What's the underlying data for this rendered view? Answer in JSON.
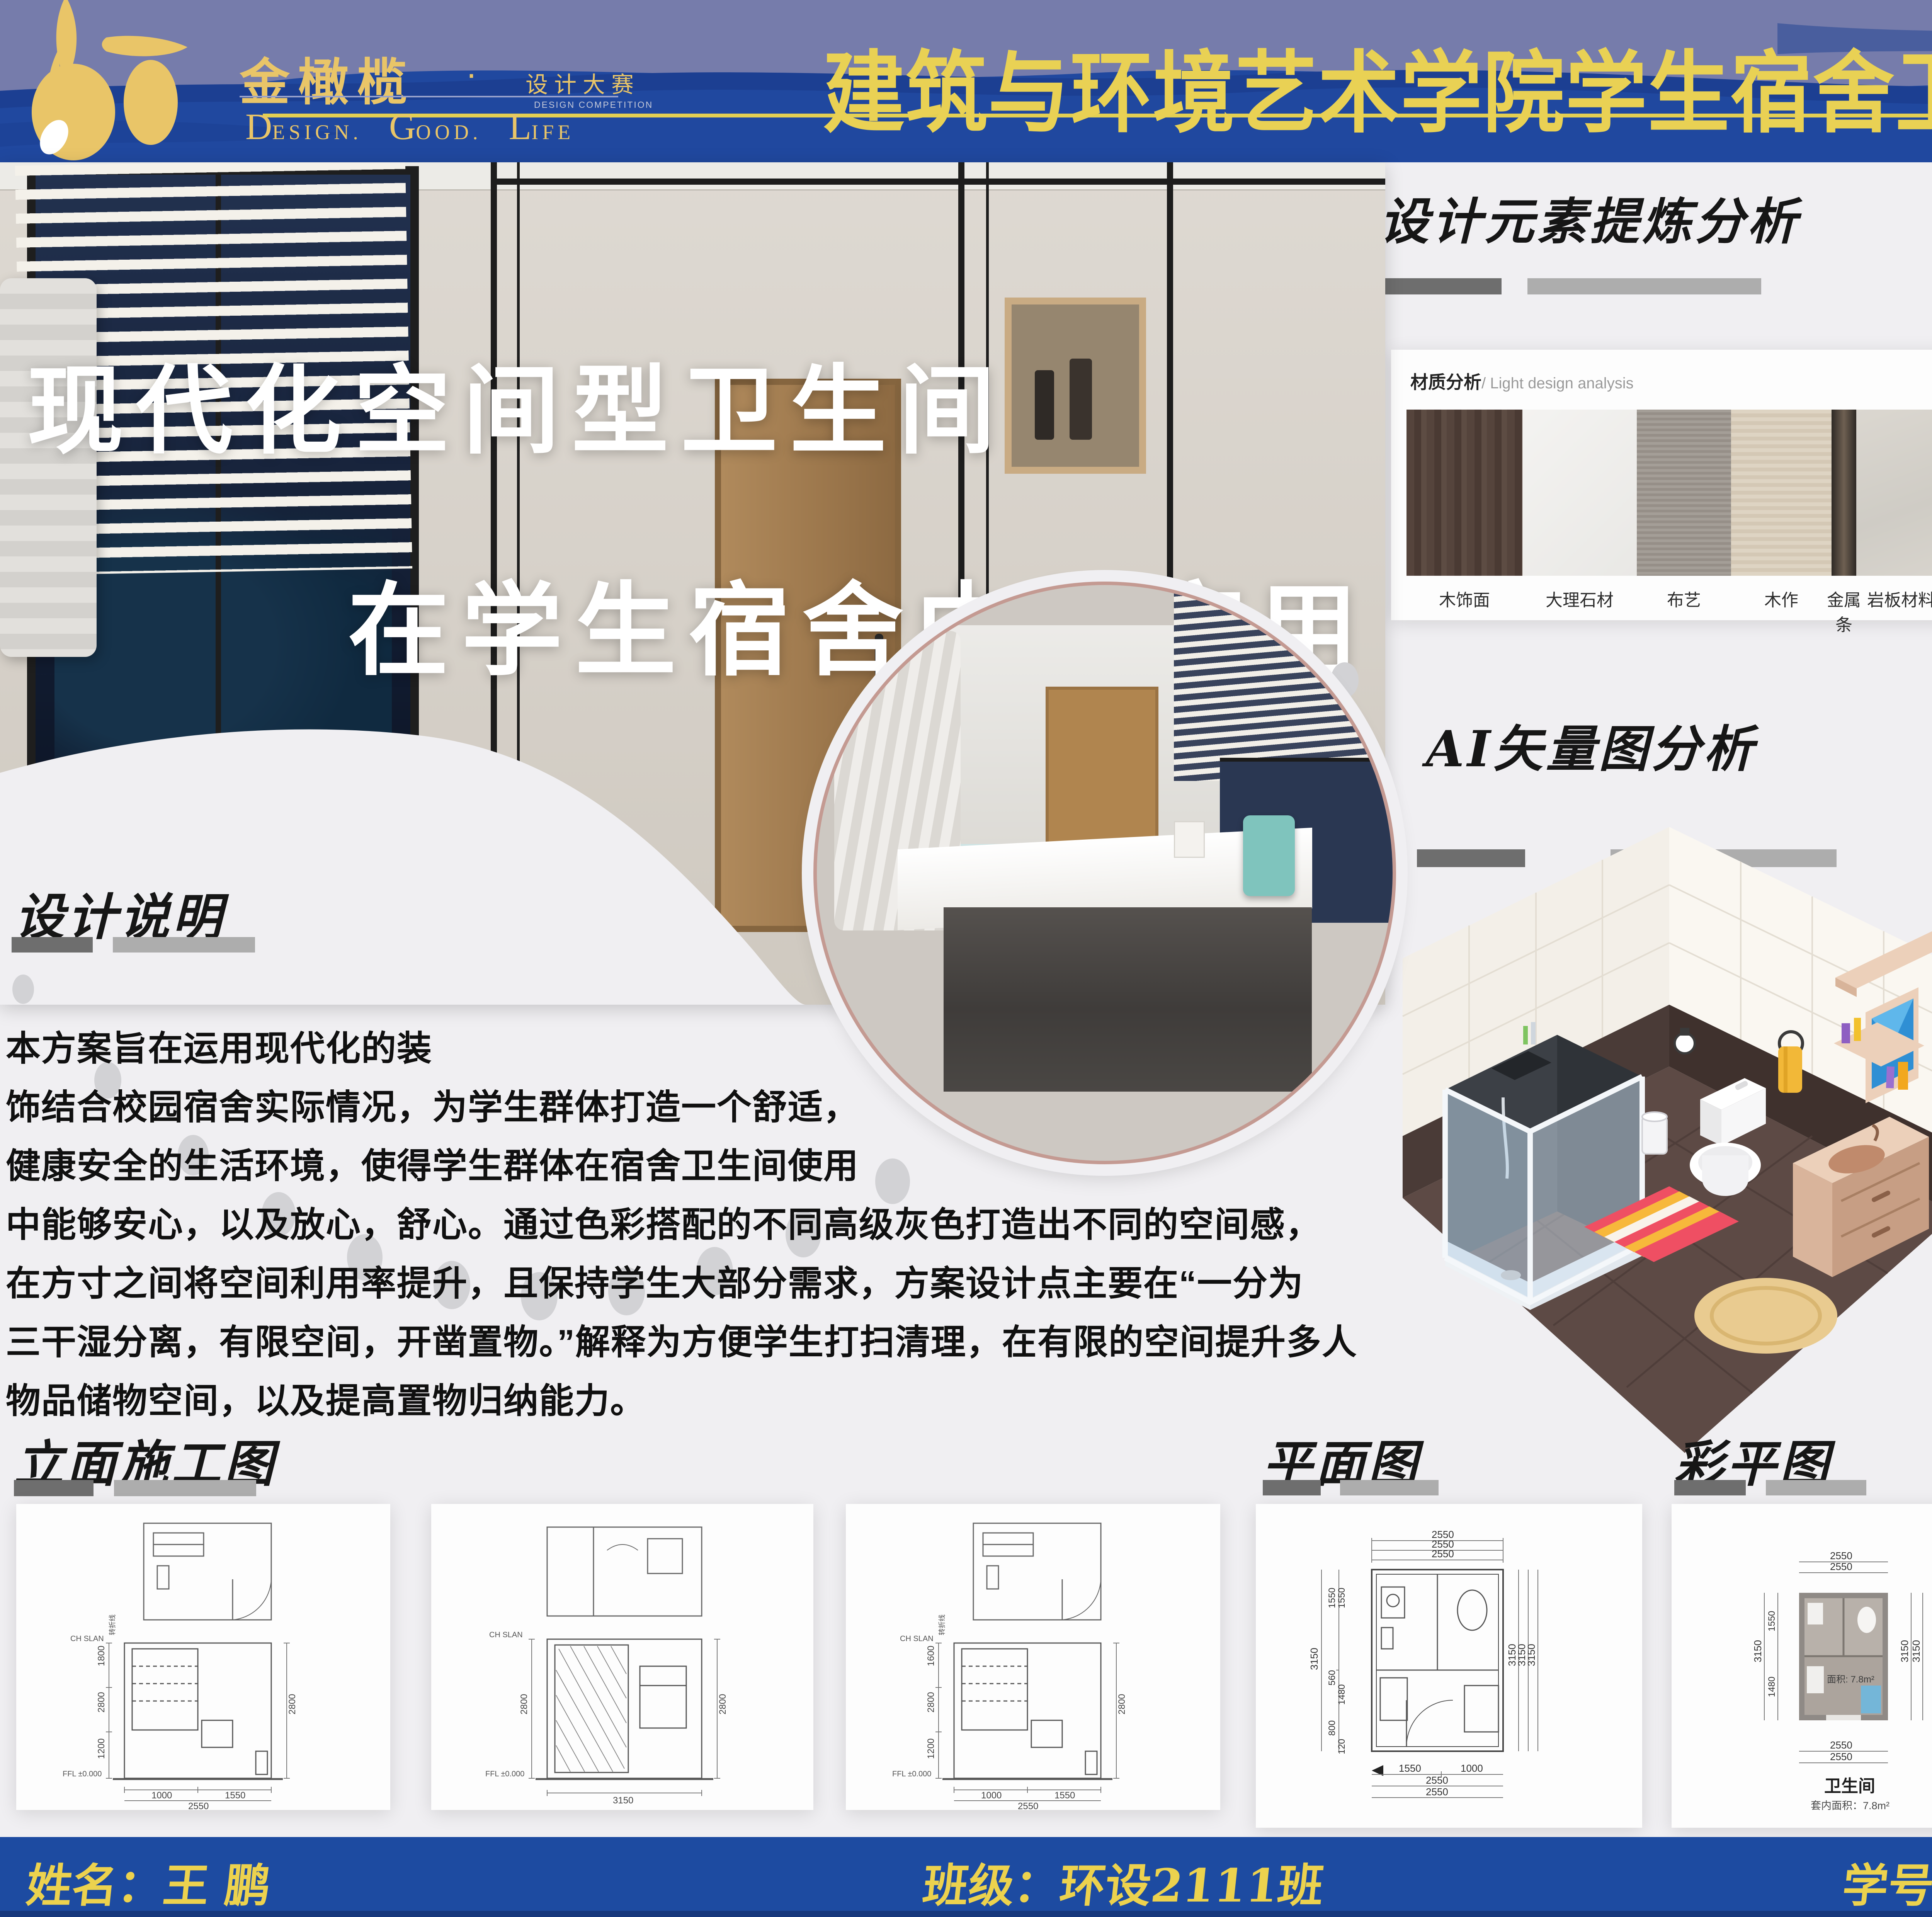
{
  "header": {
    "brand": "金橄榄",
    "brand_dot": "·",
    "brand_sub": "设计大赛",
    "brand_sub_en": "DESIGN COMPETITION",
    "slogan": [
      {
        "cap": "D",
        "rest": "ESIGN."
      },
      {
        "cap": "G",
        "rest": "OOD."
      },
      {
        "cap": "L",
        "rest": "IFE"
      }
    ],
    "title": "建筑与环境艺术学院学生宿舍卫生间设计大赛"
  },
  "hero": {
    "title_line1": "现代化空间型卫生间",
    "title_line2": "在学生宿舍中的应用"
  },
  "elements": {
    "title": "设计元素提炼分析",
    "card_label": "材质分析",
    "card_label_en": "/ Light design analysis",
    "materials": [
      {
        "label": "木饰面"
      },
      {
        "label": "大理石材"
      },
      {
        "label": "布艺"
      },
      {
        "label": "木作"
      },
      {
        "label": "金属条"
      },
      {
        "label": "岩板材料"
      },
      {
        "label": "艺术墙布"
      }
    ]
  },
  "effects": {
    "title": "白天及夜间效果图",
    "heater_brand": "Haier"
  },
  "ai": {
    "title": "AI矢量图分析"
  },
  "desc": {
    "title": "设计说明",
    "lines": [
      "本方案旨在运用现代化的装",
      "饰结合校园宿舍实际情况，为学生群体打造一个舒适，",
      "健康安全的生活环境，使得学生群体在宿舍卫生间使用",
      "中能够安心，以及放心，舒心。通过色彩搭配的不同高级灰色打造出不同的空间感，",
      "在方寸之间将空间利用率提升，且保持学生大部分需求，方案设计点主要在“一分为",
      "三干湿分离，有限空间，开凿置物。”解释为方便学生打扫清理，在有限的空间提升多人",
      "物品储物空间，以及提高置物归纳能力。"
    ]
  },
  "elevation": {
    "title": "立面施工图",
    "note_fold": "转折线",
    "note_ch": "CH SLAN",
    "note_ffl": "FFL ±0.000",
    "cards": [
      {
        "left": [
          "1800",
          "2800",
          "1200"
        ],
        "right": "2800",
        "bottom": [
          "1000",
          "1550"
        ],
        "total": "2550"
      },
      {
        "left": [
          "2800"
        ],
        "right": "2800",
        "bottom": [],
        "total": "3150"
      },
      {
        "left": [
          "1600",
          "2800",
          "1200"
        ],
        "right": "2800",
        "bottom": [
          "1000",
          "1550"
        ],
        "total": "2550"
      }
    ]
  },
  "plan": {
    "title": "平面图",
    "top": [
      "2550",
      "2550",
      "2550"
    ],
    "left": [
      "3150",
      "1550",
      "1550",
      "560",
      "1480",
      "800",
      "120"
    ],
    "right": [
      "3150",
      "3150",
      "3150"
    ],
    "bottom": [
      "1550",
      "1000",
      "2550",
      "2550"
    ]
  },
  "colorplan": {
    "title": "彩平图",
    "north": "N",
    "top": [
      "2550",
      "2550"
    ],
    "left": [
      "3150",
      "1550",
      "1480"
    ],
    "right": [
      "3150",
      "3150"
    ],
    "bottom": [
      "2550",
      "2550"
    ],
    "inner_area": "面积: 7.8m²",
    "caption": "卫生间",
    "caption_sub": "套内面积：7.8m²"
  },
  "footer": {
    "name": "姓名：王 鹏",
    "class": "班级：环设2111班",
    "student_id": "学号：202140960"
  },
  "colors": {
    "header_blue": "#20489f",
    "wave_slate": "#767cab",
    "wave_dark": "#1c3f92",
    "accent_yellow": "#e9d154",
    "gold": "#e9c568",
    "footer_blue": "#1d4ba1",
    "bar_dark": "#6e6e6e",
    "bar_light": "#adadad"
  }
}
